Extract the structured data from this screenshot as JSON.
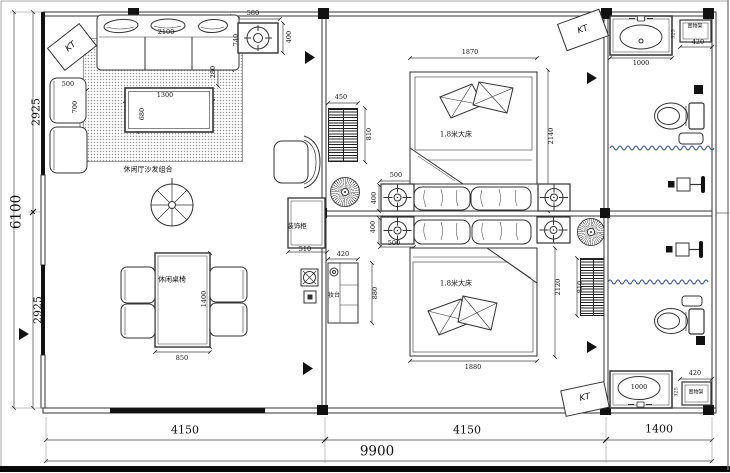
{
  "drawing": {
    "labels": {
      "kt": "KT",
      "sofa_group": "休闲厅沙发组合",
      "dining_set": "休闲桌椅",
      "bed": "1.8米大床",
      "deco_cabinet": "装饰柜",
      "dresser": "妆台",
      "shelf": "置物架"
    },
    "dims": {
      "overall_w": "9900",
      "overall_h": "6100",
      "bay_left": "4150",
      "bay_mid": "4150",
      "bay_right": "1400",
      "left_top": "2925",
      "left_bottom": "2925",
      "ac_w": "580",
      "ac_h": "400",
      "sofa_w": "2100",
      "sofa_d": "740",
      "sofa_gap": "280",
      "side_chair_w": "500",
      "side_chair_d": "700",
      "coffee_w": "1300",
      "coffee_h": "680",
      "dining_w": "850",
      "dining_l": "1400",
      "shoe_cab_w": "450",
      "shoe_cab_h": "810",
      "deco_cab_w": "510",
      "dresser_w": "420",
      "dresser_h": "880",
      "ns_top_w": "500",
      "ns_top_h": "400",
      "ns_bot_h": "400",
      "ns_bot_w": "500",
      "bed1_w": "1870",
      "bed1_l": "2140",
      "bed2_w": "1880",
      "bed2_l": "2120",
      "cab2_h": "810",
      "bath1_sink_w": "1000",
      "bath1_shelf_w": "420",
      "bath1_gap": "325",
      "bath2_sink_w": "1000",
      "bath2_shelf_w": "420",
      "bath2_gap": "325"
    }
  }
}
